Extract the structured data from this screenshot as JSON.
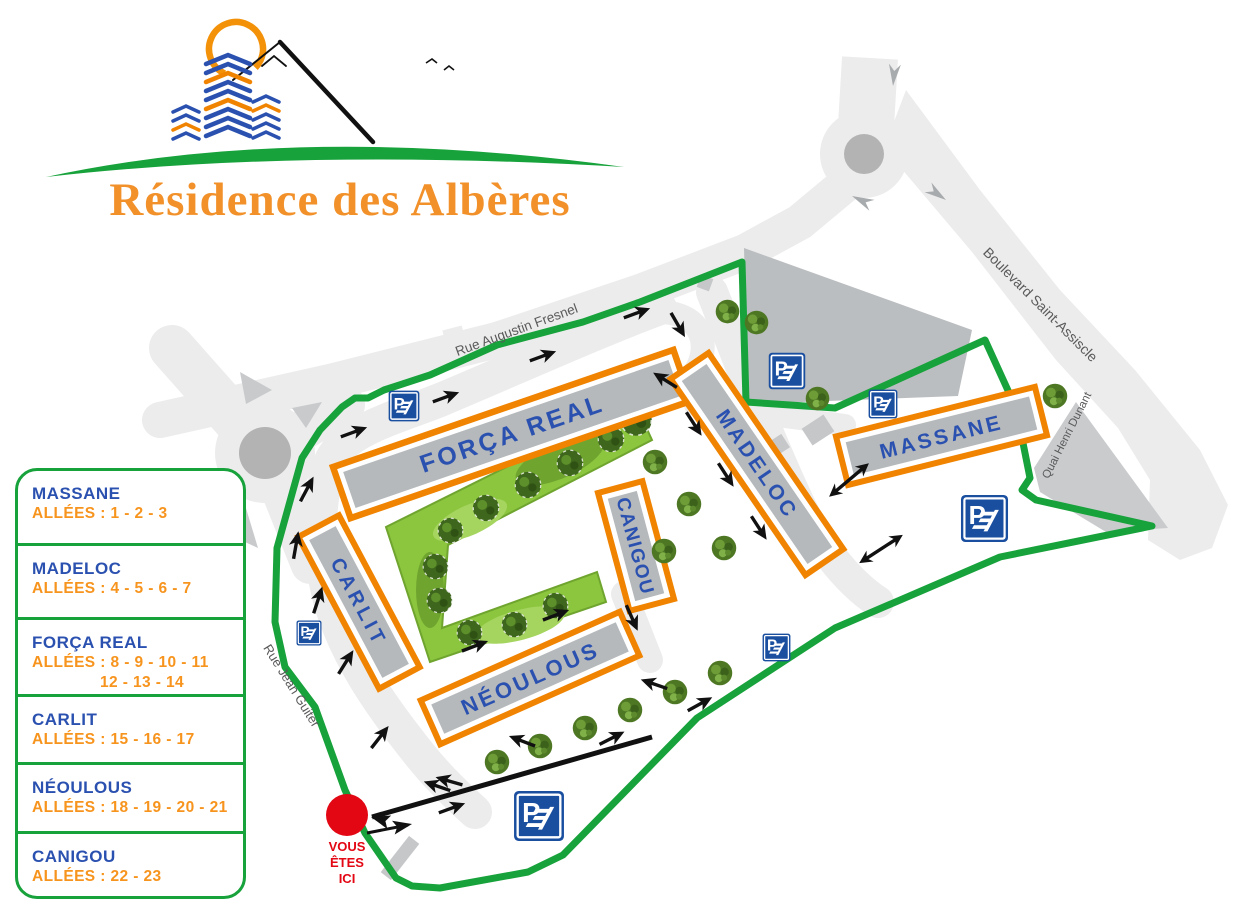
{
  "title": "Résidence des Albères",
  "legend": {
    "items": [
      {
        "name": "MASSANE",
        "alleys": "ALLÉES : 1 - 2 - 3"
      },
      {
        "name": "MADELOC",
        "alleys": "ALLÉES : 4 - 5 - 6 - 7"
      },
      {
        "name": "FORÇA REAL",
        "alleys": "ALLÉES : 8 - 9 - 10 - 11",
        "alleys2": "12 - 13 - 14"
      },
      {
        "name": "CARLIT",
        "alleys": "ALLÉES : 15 - 16 - 17"
      },
      {
        "name": "NÉOULOUS",
        "alleys": "ALLÉES : 18 - 19 - 20 - 21"
      },
      {
        "name": "CANIGOU",
        "alleys": "ALLÉES : 22 - 23"
      }
    ]
  },
  "map": {
    "buildings": [
      {
        "label": "FORÇA REAL"
      },
      {
        "label": "MADELOC"
      },
      {
        "label": "CANIGOU"
      },
      {
        "label": "CARLIT"
      },
      {
        "label": "NÉOULOUS"
      },
      {
        "label": "MASSANE"
      }
    ],
    "streets": {
      "top": "Rue Augustin Fresnel",
      "right": "Boulevard Saint-Assiscle",
      "quai": "Quai Henri Dunant",
      "left": "Rue Jean Guiter"
    },
    "you_are_here": {
      "line1": "VOUS",
      "line2": "ÊTES",
      "line3": "ICI"
    },
    "parking_letter": "P",
    "colors": {
      "boundary_green": "#17A23B",
      "building_border_orange": "#F08300",
      "building_label_blue": "#2B51B0",
      "legend_orange": "#F7941E",
      "you_are_here_red": "#E30613",
      "parking_blue": "#1A4FA0",
      "title_orange": "#F2912A",
      "road_gray": "#ECECEC",
      "building_gray": "#B5B9BB"
    }
  }
}
